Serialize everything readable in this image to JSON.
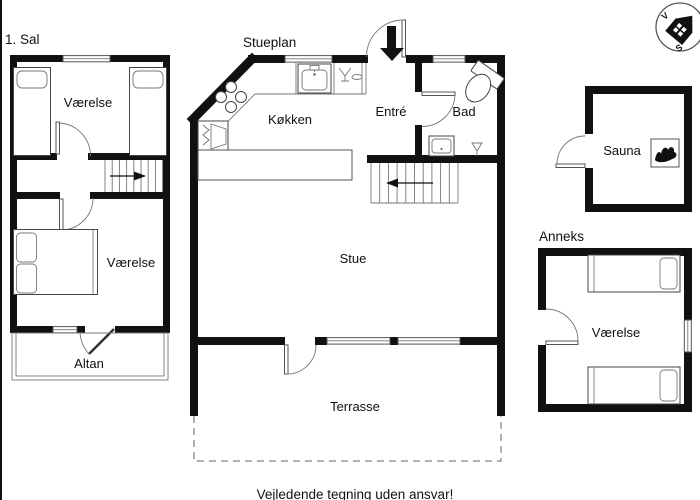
{
  "labels": {
    "first_floor_title": "1. Sal",
    "ground_floor_title": "Stueplan",
    "annex_title": "Anneks",
    "first_floor_bedroom_top": "Værelse",
    "first_floor_bedroom_bottom": "Værelse",
    "balcony": "Altan",
    "kitchen": "Køkken",
    "entry": "Entré",
    "bathroom": "Bad",
    "living_room": "Stue",
    "terrace": "Terrasse",
    "sauna": "Sauna",
    "annex_bedroom": "Værelse",
    "disclaimer": "Vejledende tegning uden ansvar!"
  },
  "compass": {
    "west": "V",
    "south": "S"
  },
  "colors": {
    "wall": "#111111",
    "fixture_line": "#555555",
    "dashed_line": "#999999",
    "background": "#ffffff"
  }
}
